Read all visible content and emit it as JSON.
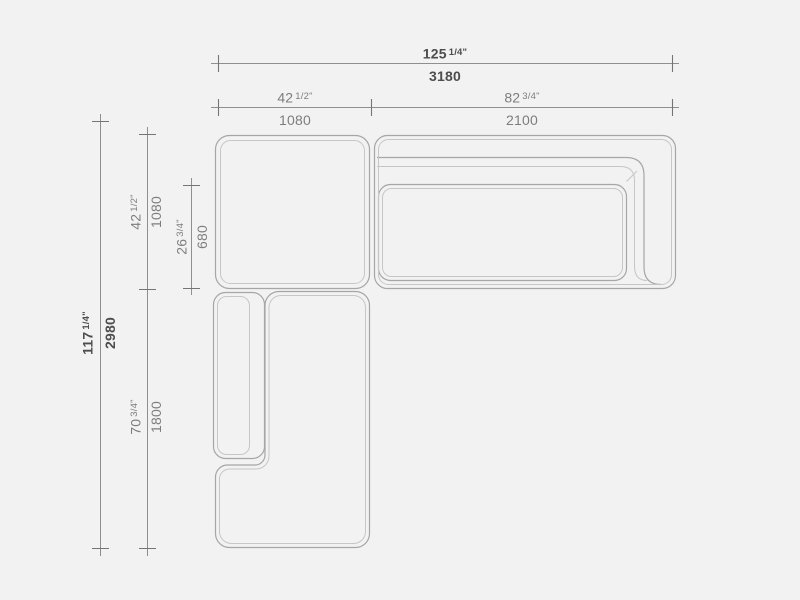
{
  "palette": {
    "background": "#f2f2f2",
    "outline": "#a6a6a6",
    "outline_light": "#c6c6c6",
    "dim_line": "#8f8f8f",
    "tick_line": "#757575",
    "text_primary": "#4d4d4d",
    "text_secondary": "#7d7d7d"
  },
  "drawing": {
    "type": "sectional-sofa-top-view-dimension-drawing"
  },
  "dimensions": {
    "total_width": {
      "inches": "125",
      "fraction": "1/4\"",
      "mm": "3180"
    },
    "left_module_width": {
      "inches": "42",
      "fraction": "1/2\"",
      "mm": "1080"
    },
    "right_module_width": {
      "inches": "82",
      "fraction": "3/4\"",
      "mm": "2100"
    },
    "total_depth": {
      "inches": "117",
      "fraction": "1/4\"",
      "mm": "2980"
    },
    "left_module_depth": {
      "inches": "42",
      "fraction": "1/2\"",
      "mm": "1080"
    },
    "seat_depth": {
      "inches": "26",
      "fraction": "3/4\"",
      "mm": "680"
    },
    "chaise_length": {
      "inches": "70",
      "fraction": "3/4\"",
      "mm": "1800"
    }
  }
}
